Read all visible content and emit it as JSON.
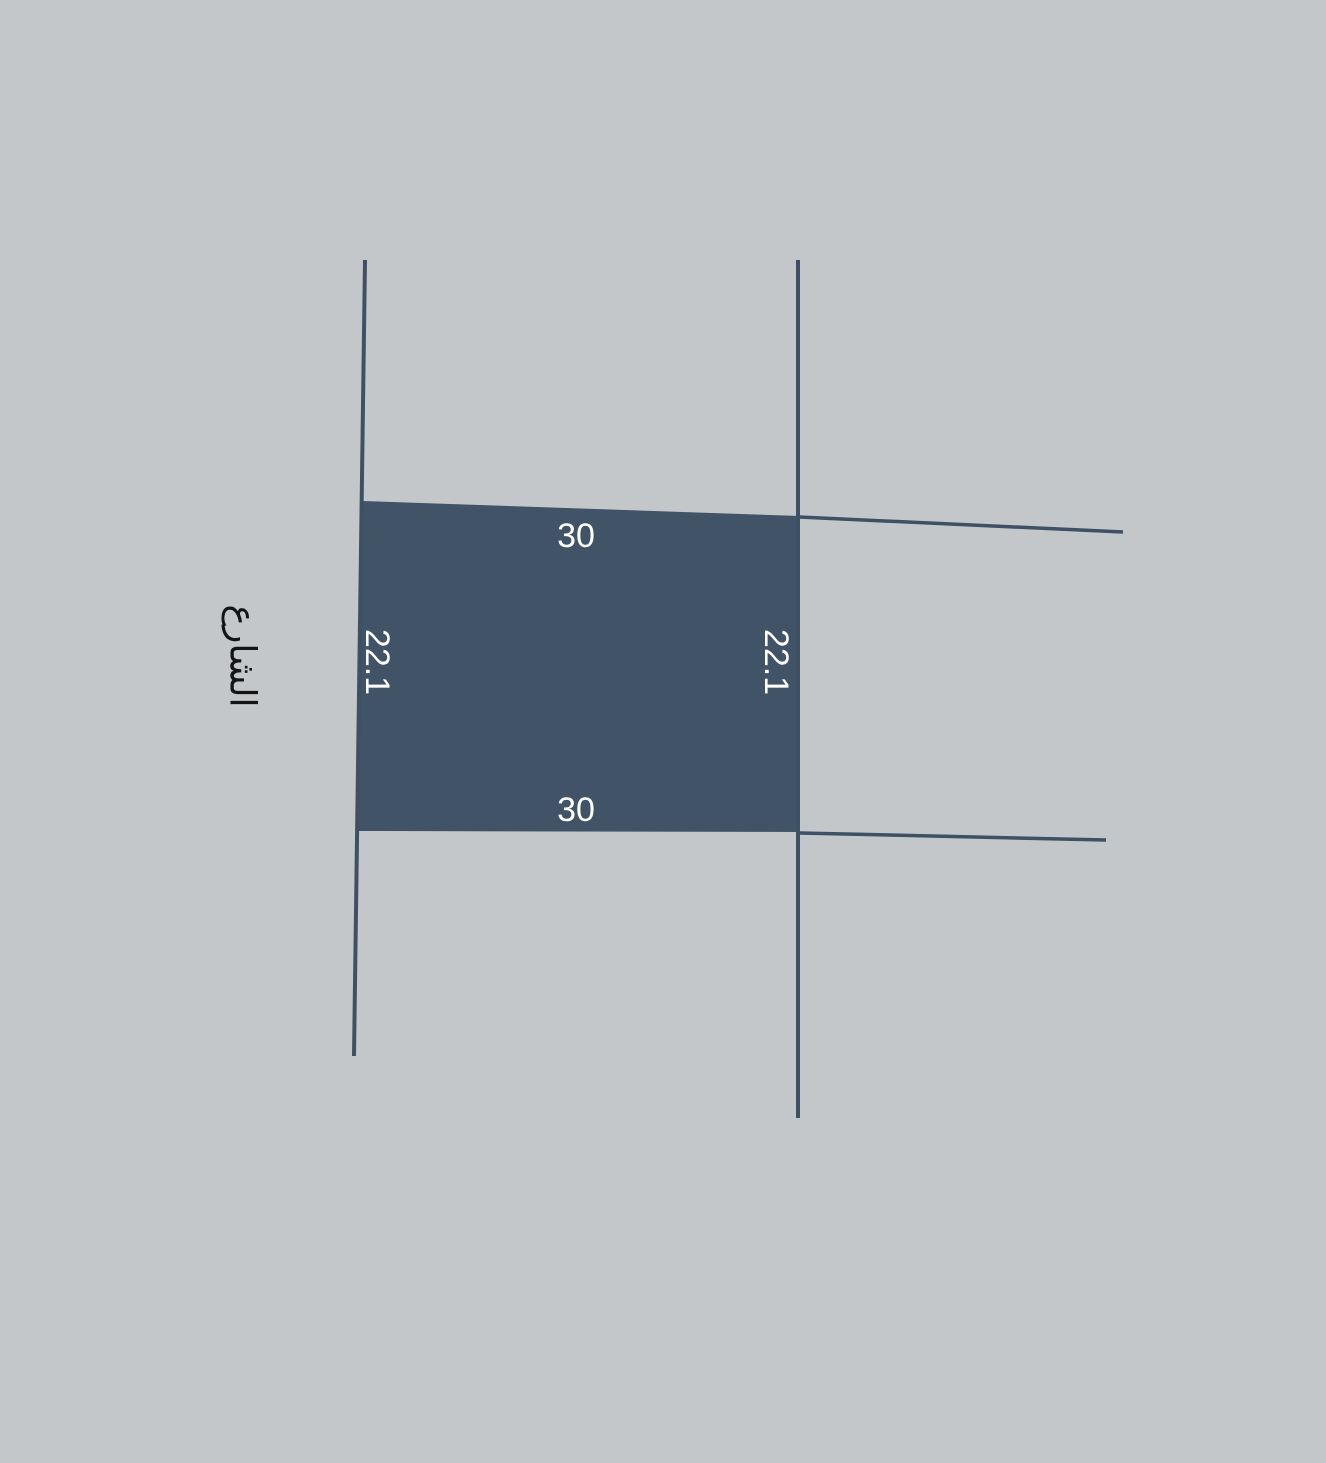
{
  "diagram": {
    "type": "land-parcel-plan",
    "parcel": {
      "top_dimension": "30",
      "bottom_dimension": "30",
      "left_dimension": "22.1",
      "right_dimension": "22.1"
    },
    "street_label": "الشارع",
    "colors": {
      "background": "#c3c7ca",
      "parcel_fill": "#415366",
      "boundary_line": "#3d5064",
      "dimension_text": "#ffffff",
      "street_text": "#141414"
    }
  }
}
